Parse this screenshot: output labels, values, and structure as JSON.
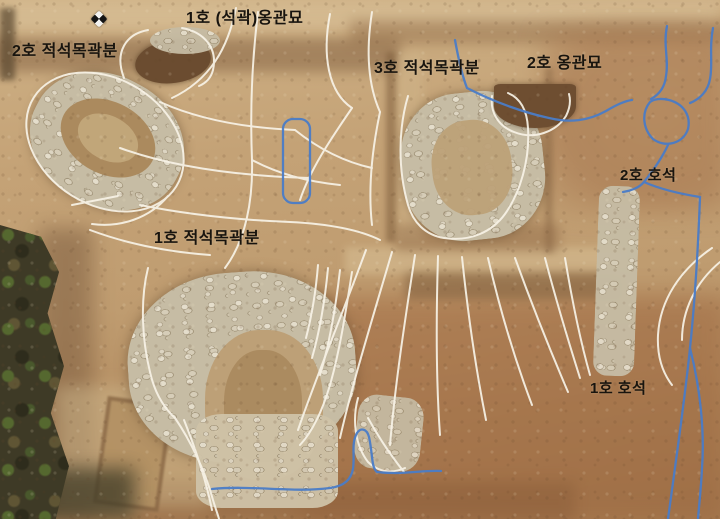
{
  "meta": {
    "title": "Aerial photograph of archaeological excavation site with tomb annotations",
    "width_px": 720,
    "height_px": 519
  },
  "labels": [
    {
      "id": "jar-burial-1",
      "text": "1호 (석곽)옹관묘"
    },
    {
      "id": "stone-tomb-2",
      "text": "2호 적석목곽분"
    },
    {
      "id": "stone-tomb-3",
      "text": "3호 적석목곽분"
    },
    {
      "id": "jar-burial-2",
      "text": "2호 옹관묘"
    },
    {
      "id": "hoseok-2",
      "text": "2호 호석"
    },
    {
      "id": "stone-tomb-1",
      "text": "1호 적석목곽분"
    },
    {
      "id": "hoseok-1",
      "text": "1호 호석"
    }
  ],
  "annotations": {
    "outline_color_white": "#f8f3e7",
    "boundary_color_blue": "#4a7cc7",
    "label_color": "#18140e"
  },
  "markers": [
    {
      "id": "gcp-marker",
      "type": "checkered ground-control marker"
    }
  ]
}
